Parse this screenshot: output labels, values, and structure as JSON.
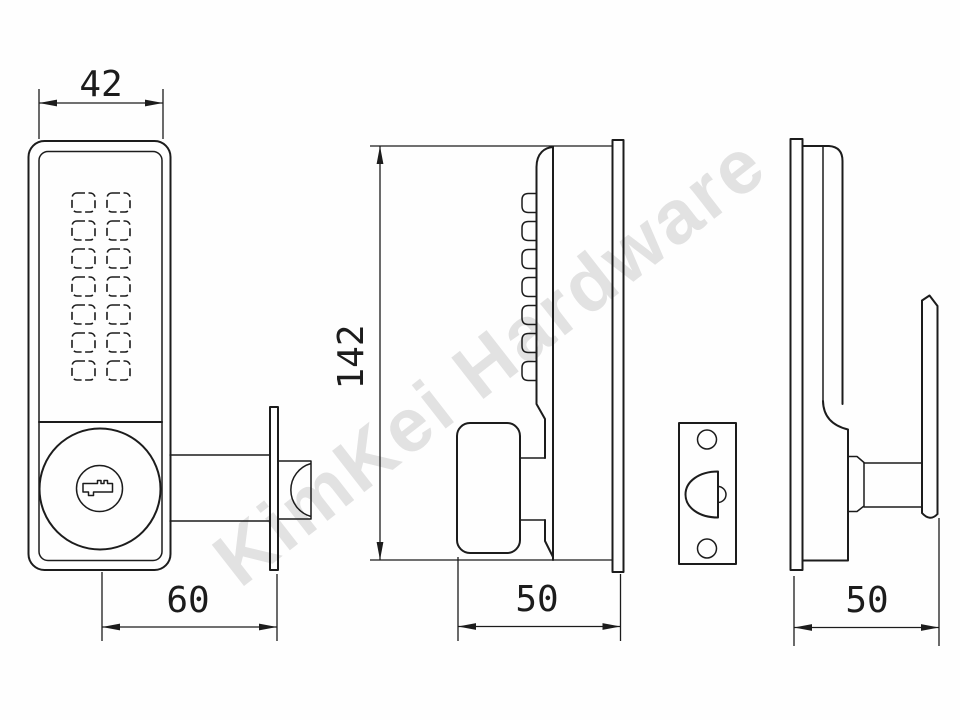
{
  "watermark": {
    "text": "KimKei Hardware"
  },
  "colors": {
    "background": "#fefefe",
    "line": "#1c1c1c",
    "watermark": "#e2e2e2"
  },
  "dimensions": {
    "front_width": "42",
    "overall_height": "142",
    "front_backset": "60",
    "exterior_depth": "50",
    "interior_depth": "50"
  },
  "keypad": {
    "rows": 7,
    "columns": 2,
    "buttons": 14
  }
}
